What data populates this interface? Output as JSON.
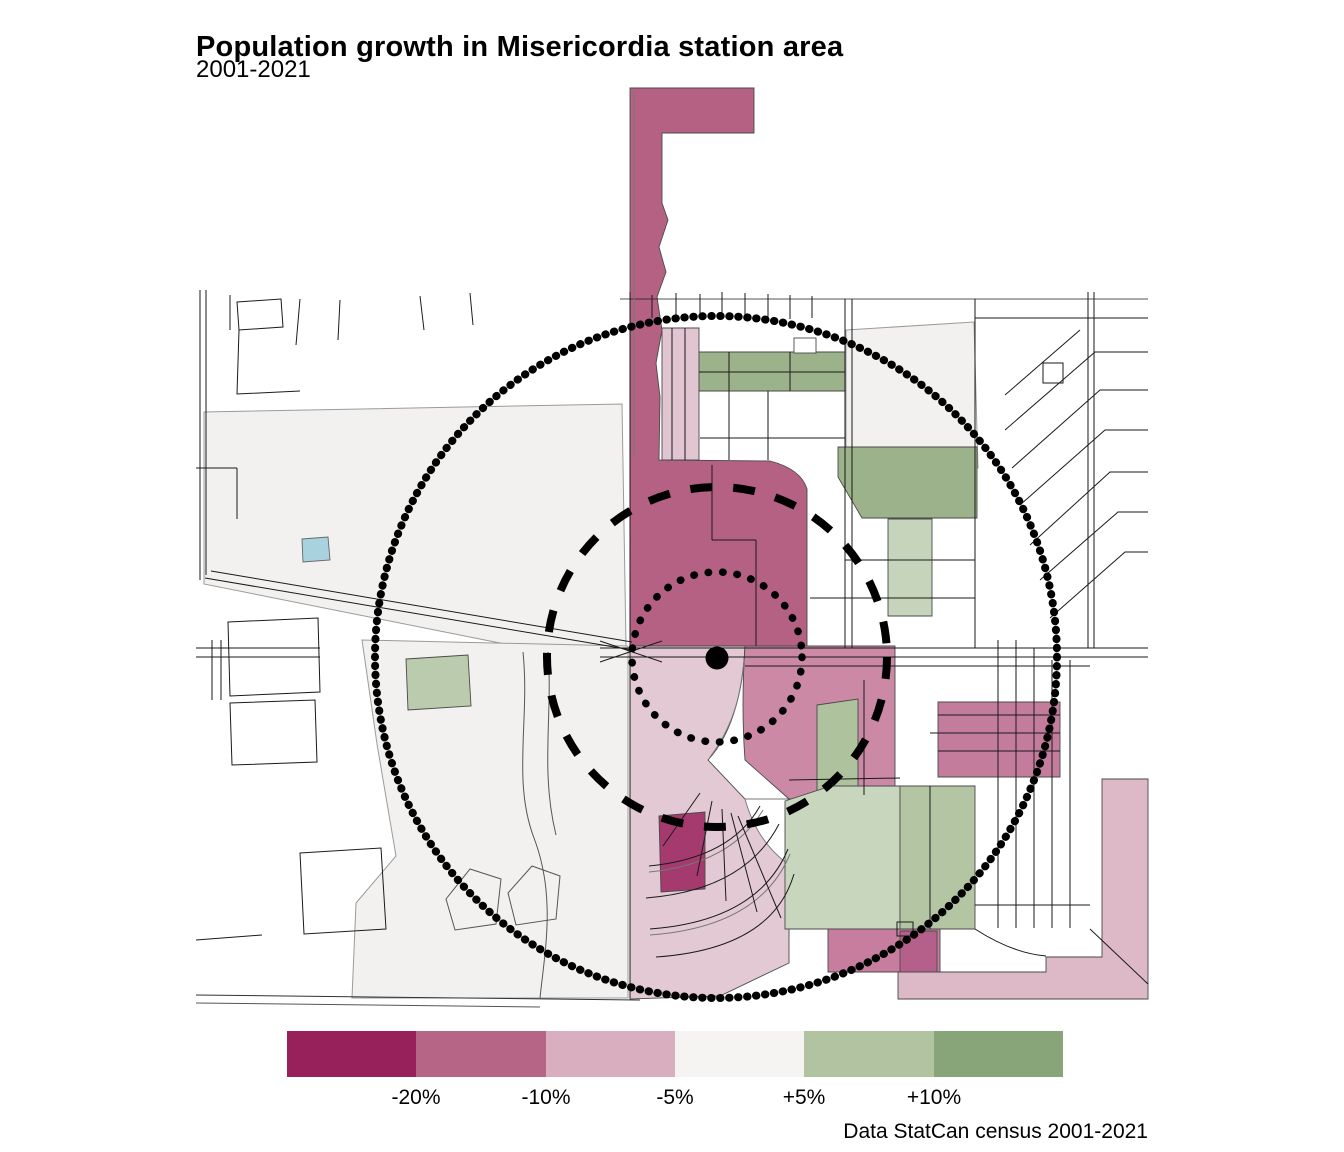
{
  "title": "Population growth in Misericordia station area",
  "subtitle": "2001-2021",
  "caption": "Data StatCan census 2001-2021",
  "legend": {
    "labels": [
      "-20%",
      "-10%",
      "-5%",
      "+5%",
      "+10%"
    ],
    "colors": [
      "#97215B",
      "#B66586",
      "#D9AEBE",
      "#F5F4F2",
      "#B1C3A1",
      "#87A578"
    ],
    "bins": [
      "below -20%",
      "-20% to -10%",
      "-10% to -5%",
      "-5% to +5%",
      "+5% to +10%",
      "above +10%"
    ]
  },
  "map_colors": {
    "decline_strong": "#A43A6D",
    "decline_medium": "#B46184",
    "decline_light": "#E3C9D4",
    "stable": "#F2F1EF",
    "growth_light": "#C9D6BE",
    "growth_medium": "#9BB28B",
    "water": "#A9D2DF",
    "ring": "#000000"
  }
}
